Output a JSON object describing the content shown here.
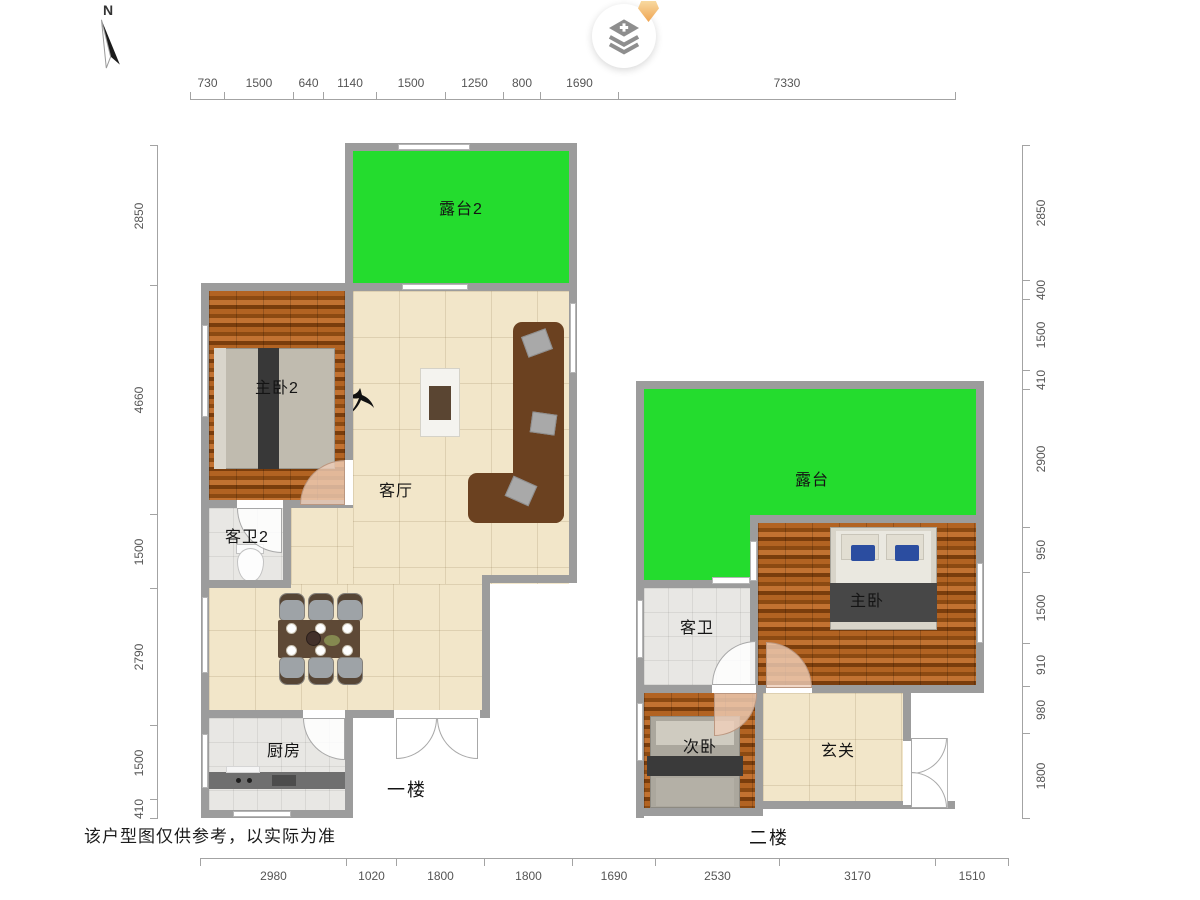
{
  "compass": {
    "north_label": "N"
  },
  "map_control": {
    "plus_glyph": "+"
  },
  "floor1": {
    "label": "一楼",
    "rooms": {
      "terrace2": "露台2",
      "bedroom2": "主卧2",
      "living": "客厅",
      "bath2": "客卫2",
      "kitchen": "厨房"
    }
  },
  "floor2": {
    "label": "二楼",
    "rooms": {
      "terrace": "露台",
      "bath": "客卫",
      "master": "主卧",
      "second_bedroom": "次卧",
      "entry_hall": "玄关"
    }
  },
  "rulers": {
    "top": [
      "730",
      "1500",
      "640",
      "1140",
      "1500",
      "1250",
      "800",
      "1690",
      "7330"
    ],
    "left": [
      "2850",
      "4660",
      "1500",
      "2790",
      "1500",
      "410"
    ],
    "right": [
      "2850",
      "400",
      "1500",
      "410",
      "2900",
      "950",
      "1500",
      "910",
      "980",
      "1800"
    ],
    "bottom": [
      "2980",
      "1020",
      "1800",
      "1800",
      "1690",
      "2530",
      "3170",
      "1510"
    ]
  },
  "disclaimer": "该户型图仅供参考，以实际为准",
  "colors": {
    "terrace_green": "#24dc2e",
    "wall_gray": "#9c9c9c",
    "wood_brown": "#a85c1f",
    "tile_beige": "#f2e6c9",
    "tile_gray": "#e8e7e4",
    "badge_orange": "#efa452"
  }
}
